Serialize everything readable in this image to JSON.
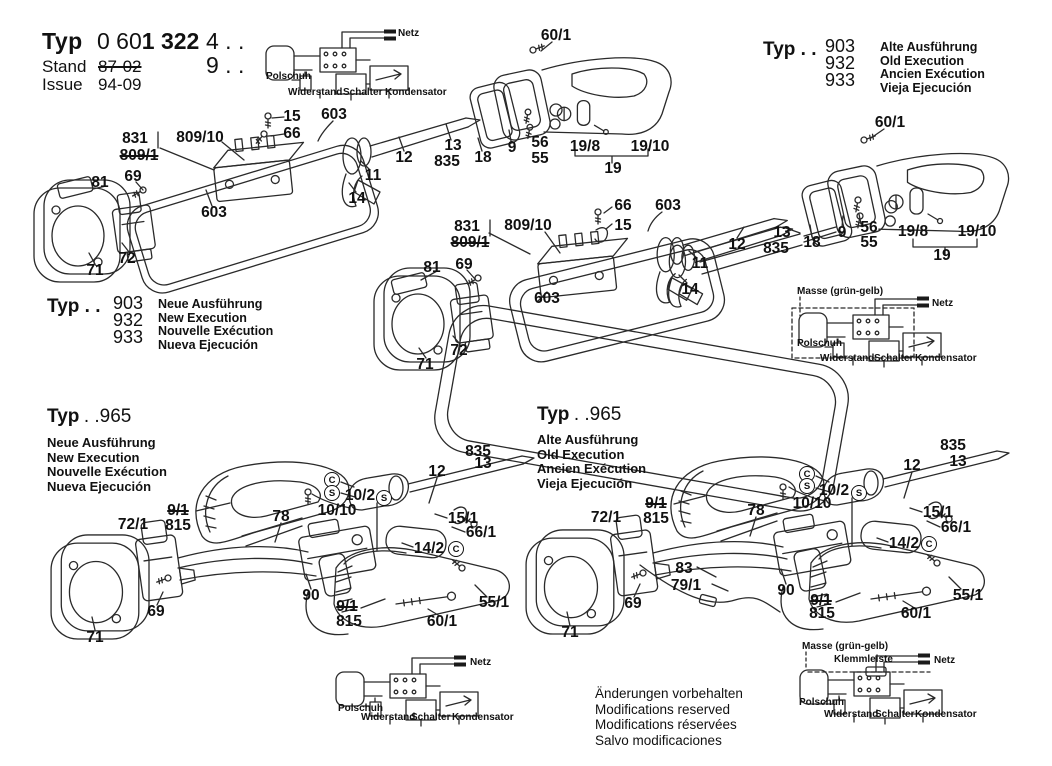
{
  "page": {
    "background": "#ffffff",
    "ink": "#111111"
  },
  "title_block": {
    "typ_label": "Typ",
    "number_light": "0 60",
    "number_bold": "1 322",
    "suffix_row1": "4 . .",
    "suffix_row2": "9 . .",
    "stand_label": "Stand",
    "stand_value": "87-02",
    "issue_label": "Issue",
    "issue_value": "94-09"
  },
  "type_blocks": {
    "old_903": {
      "typ": "Typ . .",
      "models": [
        "903",
        "932",
        "933"
      ],
      "lines": [
        "Alte Ausführung",
        "Old Execution",
        "Ancien Exécution",
        "Vieja Ejecución"
      ]
    },
    "new_903": {
      "typ": "Typ . .",
      "models": [
        "903",
        "932",
        "933"
      ],
      "lines": [
        "Neue Ausführung",
        "New Execution",
        "Nouvelle Exécution",
        "Nueva Ejecución"
      ]
    },
    "new_965": {
      "typ": "Typ",
      "model": ". .965",
      "lines": [
        "Neue Ausführung",
        "New Execution",
        "Nouvelle Exécution",
        "Nueva Ejecución"
      ]
    },
    "old_965": {
      "typ": "Typ",
      "model": ". .965",
      "lines": [
        "Alte Ausführung",
        "Old Execution",
        "Ancien Exécution",
        "Vieja Ejecución"
      ]
    }
  },
  "schematics": {
    "s1": {
      "netz": "Netz",
      "polschuh": "Polschuh",
      "widerstand": "Widerstand",
      "schalter": "Schalter",
      "kondensator": "Kondensator"
    },
    "s2": {
      "masse": "Masse (grün-gelb)",
      "netz": "Netz",
      "polschuh": "Polschuh",
      "widerstand": "Widerstand",
      "schalter": "Schalter",
      "kondensator": "Kondensator"
    },
    "s3": {
      "netz": "Netz",
      "polschuh": "Polschuh",
      "widerstand": "Widerstand",
      "schalter": "Schalter",
      "kondensator": "Kondensator"
    },
    "s4": {
      "masse": "Masse (grün-gelb)",
      "klemmleiste": "Klemmleiste",
      "netz": "Netz",
      "polschuh": "Polschuh",
      "widerstand": "Widerstand",
      "schalter": "Schalter",
      "kondensator": "Kondensator"
    }
  },
  "callouts": {
    "d1": [
      {
        "t": "831",
        "x": 135,
        "y": 139
      },
      {
        "t": "809/1",
        "x": 139,
        "y": 156,
        "strike": 1
      },
      {
        "t": "809/10",
        "x": 200,
        "y": 138
      },
      {
        "t": "15",
        "x": 292,
        "y": 117
      },
      {
        "t": "66",
        "x": 292,
        "y": 134
      },
      {
        "t": "603",
        "x": 334,
        "y": 115
      },
      {
        "t": "603",
        "x": 214,
        "y": 213
      },
      {
        "t": "81",
        "x": 100,
        "y": 183
      },
      {
        "t": "69",
        "x": 133,
        "y": 177
      },
      {
        "t": "71",
        "x": 95,
        "y": 271
      },
      {
        "t": "72",
        "x": 127,
        "y": 259
      },
      {
        "t": "11",
        "x": 373,
        "y": 176
      },
      {
        "t": "14",
        "x": 357,
        "y": 199
      },
      {
        "t": "12",
        "x": 404,
        "y": 158
      },
      {
        "t": "13",
        "x": 453,
        "y": 146
      },
      {
        "t": "835",
        "x": 447,
        "y": 162
      },
      {
        "t": "18",
        "x": 483,
        "y": 158
      },
      {
        "t": "9",
        "x": 512,
        "y": 148
      },
      {
        "t": "56",
        "x": 540,
        "y": 143
      },
      {
        "t": "55",
        "x": 540,
        "y": 159
      },
      {
        "t": "19/8",
        "x": 585,
        "y": 147
      },
      {
        "t": "19/10",
        "x": 650,
        "y": 147
      },
      {
        "t": "19",
        "x": 613,
        "y": 169
      },
      {
        "t": "60/1",
        "x": 556,
        "y": 36
      }
    ],
    "d2": [
      {
        "t": "60/1",
        "x": 890,
        "y": 123
      },
      {
        "t": "12",
        "x": 737,
        "y": 245
      },
      {
        "t": "13",
        "x": 782,
        "y": 233
      },
      {
        "t": "835",
        "x": 776,
        "y": 249
      },
      {
        "t": "18",
        "x": 812,
        "y": 243
      },
      {
        "t": "9",
        "x": 842,
        "y": 233
      },
      {
        "t": "56",
        "x": 869,
        "y": 228
      },
      {
        "t": "55",
        "x": 869,
        "y": 243
      },
      {
        "t": "19/8",
        "x": 913,
        "y": 232
      },
      {
        "t": "19/10",
        "x": 977,
        "y": 232
      },
      {
        "t": "19",
        "x": 942,
        "y": 256
      }
    ],
    "d3": [
      {
        "t": "66",
        "x": 623,
        "y": 206
      },
      {
        "t": "15",
        "x": 623,
        "y": 226
      },
      {
        "t": "603",
        "x": 668,
        "y": 206
      },
      {
        "t": "831",
        "x": 467,
        "y": 227
      },
      {
        "t": "809/1",
        "x": 470,
        "y": 243,
        "strike": 1
      },
      {
        "t": "809/10",
        "x": 528,
        "y": 226
      },
      {
        "t": "81",
        "x": 432,
        "y": 268
      },
      {
        "t": "69",
        "x": 464,
        "y": 265
      },
      {
        "t": "603",
        "x": 547,
        "y": 299
      },
      {
        "t": "71",
        "x": 425,
        "y": 365
      },
      {
        "t": "72",
        "x": 459,
        "y": 351
      },
      {
        "t": "11",
        "x": 700,
        "y": 264
      },
      {
        "t": "14",
        "x": 690,
        "y": 290
      }
    ],
    "d4": [
      {
        "t": "835",
        "x": 478,
        "y": 452
      },
      {
        "t": "13",
        "x": 483,
        "y": 464
      },
      {
        "t": "12",
        "x": 437,
        "y": 472
      },
      {
        "t": "C",
        "x": 332,
        "y": 480,
        "circle": 1
      },
      {
        "t": "S",
        "x": 332,
        "y": 493,
        "circle": 1
      },
      {
        "t": "10/2",
        "x": 360,
        "y": 496
      },
      {
        "t": "S",
        "x": 384,
        "y": 498,
        "circle": 1
      },
      {
        "t": "10/10",
        "x": 337,
        "y": 511
      },
      {
        "t": "9/1",
        "x": 178,
        "y": 511,
        "strike": 1
      },
      {
        "t": "815",
        "x": 178,
        "y": 526
      },
      {
        "t": "72/1",
        "x": 133,
        "y": 525
      },
      {
        "t": "78",
        "x": 281,
        "y": 517
      },
      {
        "t": "15/1",
        "x": 463,
        "y": 519
      },
      {
        "t": "66/1",
        "x": 481,
        "y": 533
      },
      {
        "t": "14/2",
        "x": 429,
        "y": 549
      },
      {
        "t": "C",
        "x": 456,
        "y": 549,
        "circle": 1
      },
      {
        "t": "90",
        "x": 311,
        "y": 596
      },
      {
        "t": "9/1",
        "x": 347,
        "y": 607,
        "strike": 1
      },
      {
        "t": "815",
        "x": 349,
        "y": 622
      },
      {
        "t": "69",
        "x": 156,
        "y": 612
      },
      {
        "t": "55/1",
        "x": 494,
        "y": 603
      },
      {
        "t": "60/1",
        "x": 442,
        "y": 622
      },
      {
        "t": "71",
        "x": 95,
        "y": 638
      }
    ],
    "d5": [
      {
        "t": "835",
        "x": 953,
        "y": 446
      },
      {
        "t": "13",
        "x": 958,
        "y": 462
      },
      {
        "t": "12",
        "x": 912,
        "y": 466
      },
      {
        "t": "C",
        "x": 807,
        "y": 474,
        "circle": 1
      },
      {
        "t": "S",
        "x": 807,
        "y": 486,
        "circle": 1
      },
      {
        "t": "10/2",
        "x": 834,
        "y": 491
      },
      {
        "t": "S",
        "x": 859,
        "y": 493,
        "circle": 1
      },
      {
        "t": "10/10",
        "x": 812,
        "y": 504
      },
      {
        "t": "9/1",
        "x": 656,
        "y": 504,
        "strike": 1
      },
      {
        "t": "815",
        "x": 656,
        "y": 519
      },
      {
        "t": "72/1",
        "x": 606,
        "y": 518
      },
      {
        "t": "78",
        "x": 756,
        "y": 511
      },
      {
        "t": "15/1",
        "x": 938,
        "y": 513
      },
      {
        "t": "66/1",
        "x": 956,
        "y": 528
      },
      {
        "t": "14/2",
        "x": 904,
        "y": 544
      },
      {
        "t": "C",
        "x": 929,
        "y": 544,
        "circle": 1
      },
      {
        "t": "83",
        "x": 684,
        "y": 569
      },
      {
        "t": "79/1",
        "x": 686,
        "y": 586
      },
      {
        "t": "90",
        "x": 786,
        "y": 591
      },
      {
        "t": "9/1",
        "x": 821,
        "y": 601,
        "strike": 1
      },
      {
        "t": "815",
        "x": 822,
        "y": 614
      },
      {
        "t": "69",
        "x": 633,
        "y": 604
      },
      {
        "t": "55/1",
        "x": 968,
        "y": 596
      },
      {
        "t": "60/1",
        "x": 916,
        "y": 614
      },
      {
        "t": "71",
        "x": 570,
        "y": 633
      }
    ]
  },
  "footer": {
    "lines": [
      "Änderungen vorbehalten",
      "Modifications reserved",
      "Modifications réservées",
      "Salvo modificaciones"
    ]
  }
}
